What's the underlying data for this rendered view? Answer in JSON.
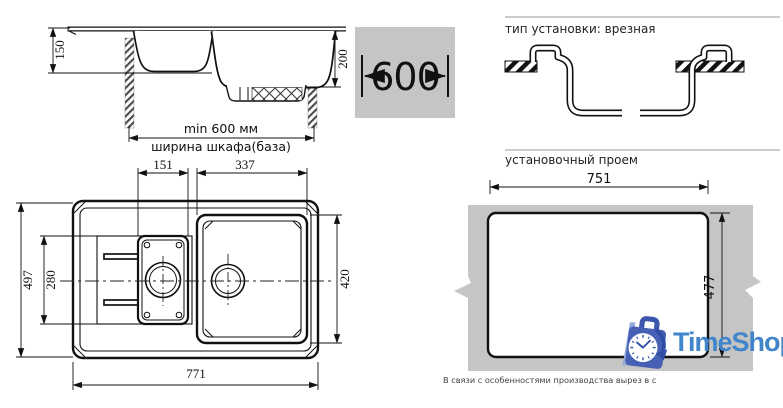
{
  "side_view": {
    "dim_bowl_depth_small": "150",
    "dim_bowl_depth_large": "200",
    "dim_min_cabinet": "min 600 мм",
    "cabinet_width_label": "ширина шкафа(база)"
  },
  "cabinet_badge": {
    "width_value": "600"
  },
  "installation": {
    "title": "тип установки: врезная"
  },
  "plan_view": {
    "dim_small_bowl_width": "151",
    "dim_large_bowl_width": "337",
    "dim_overall_width": "497",
    "dim_drainboard_height": "280",
    "dim_large_bowl_height": "420",
    "dim_overall_length": "771"
  },
  "cutout": {
    "title": "установочный проем",
    "dim_width": "751",
    "dim_height": "477"
  },
  "footnote": "В связи с особенностями производства вырез в с",
  "logo": {
    "brand": "TimeShop"
  },
  "colors": {
    "surface_gray": "#c5c5c5",
    "line_black": "#111111",
    "rule_gray": "#999999",
    "brand_blue": "#4186ca",
    "bag_blue": "#4560b4"
  }
}
